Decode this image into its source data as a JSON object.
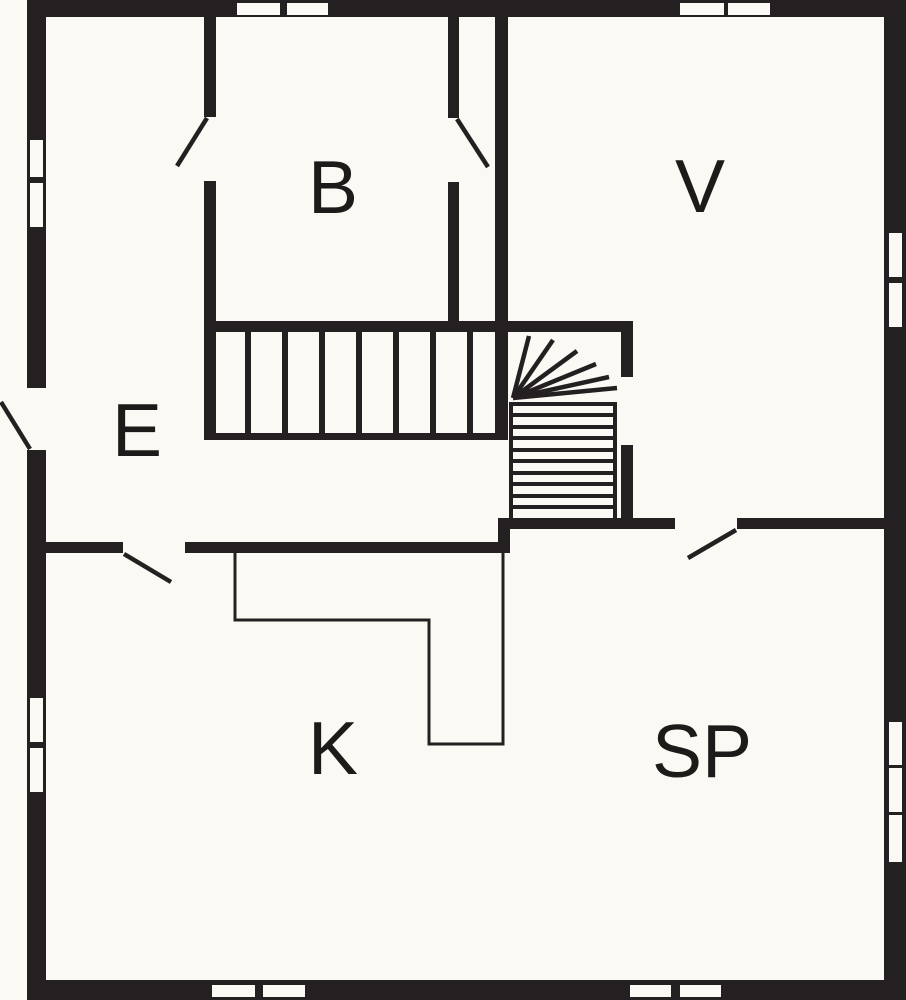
{
  "floorplan": {
    "meta": {
      "width": 906,
      "height": 1000,
      "type": "floor-plan"
    },
    "colors": {
      "wall": "#241f20",
      "floor": "#faf9f3",
      "line": "#241f20",
      "label": "#1d1b1a"
    },
    "rooms": [
      {
        "id": "b",
        "label": "B",
        "cx": 333,
        "cy": 187,
        "font": 75
      },
      {
        "id": "v",
        "label": "V",
        "cx": 700,
        "cy": 186,
        "font": 75
      },
      {
        "id": "e",
        "label": "E",
        "cx": 137,
        "cy": 430,
        "font": 75
      },
      {
        "id": "k",
        "label": "K",
        "cx": 333,
        "cy": 748,
        "font": 75
      },
      {
        "id": "sp",
        "label": "SP",
        "cx": 702,
        "cy": 751,
        "font": 75
      }
    ],
    "walls": [
      {
        "name": "exterior-wall-left",
        "x": 27,
        "y": 0,
        "w": 19,
        "h": 1000
      },
      {
        "name": "exterior-wall-top",
        "x": 27,
        "y": 0,
        "w": 879,
        "h": 17
      },
      {
        "name": "exterior-wall-right",
        "x": 884,
        "y": 0,
        "w": 22,
        "h": 1000
      },
      {
        "name": "exterior-wall-bottom",
        "x": 27,
        "y": 980,
        "w": 879,
        "h": 20
      },
      {
        "name": "wall-b-left-upper",
        "x": 204,
        "y": 17,
        "w": 12,
        "h": 100
      },
      {
        "name": "wall-b-left-lower",
        "x": 204,
        "y": 181,
        "w": 12,
        "h": 259
      },
      {
        "name": "wall-b-right-upper",
        "x": 448,
        "y": 17,
        "w": 11,
        "h": 101
      },
      {
        "name": "wall-b-right-lower",
        "x": 448,
        "y": 182,
        "w": 11,
        "h": 150
      },
      {
        "name": "wall-v-left",
        "x": 495,
        "y": 17,
        "w": 13,
        "h": 420
      },
      {
        "name": "wall-stair-top",
        "x": 204,
        "y": 321,
        "w": 429,
        "h": 11
      },
      {
        "name": "wall-stair-right-upper",
        "x": 621,
        "y": 332,
        "w": 12,
        "h": 45
      },
      {
        "name": "wall-stair-right-lower",
        "x": 621,
        "y": 445,
        "w": 12,
        "h": 74
      },
      {
        "name": "wall-stair-bottom-west",
        "x": 498,
        "y": 518,
        "w": 177,
        "h": 11
      },
      {
        "name": "wall-stair-bottom-east",
        "x": 737,
        "y": 518,
        "w": 149,
        "h": 11
      },
      {
        "name": "wall-stair-connector",
        "x": 498,
        "y": 518,
        "w": 12,
        "h": 35
      },
      {
        "name": "wall-e-k-west",
        "x": 46,
        "y": 542,
        "w": 77,
        "h": 11
      },
      {
        "name": "wall-e-k-east",
        "x": 185,
        "y": 542,
        "w": 323,
        "h": 11
      }
    ],
    "windows": [
      {
        "name": "window-left-1",
        "x": 30,
        "y": 140,
        "w": 13,
        "h": 37
      },
      {
        "name": "window-left-2",
        "x": 30,
        "y": 183,
        "w": 13,
        "h": 44
      },
      {
        "name": "window-left-3",
        "x": 30,
        "y": 698,
        "w": 13,
        "h": 44
      },
      {
        "name": "window-left-4",
        "x": 30,
        "y": 748,
        "w": 13,
        "h": 44
      },
      {
        "name": "window-top-1",
        "x": 237,
        "y": 3,
        "w": 43,
        "h": 12
      },
      {
        "name": "window-top-2",
        "x": 287,
        "y": 3,
        "w": 41,
        "h": 12
      },
      {
        "name": "window-top-3",
        "x": 680,
        "y": 3,
        "w": 44,
        "h": 12
      },
      {
        "name": "window-top-4",
        "x": 728,
        "y": 3,
        "w": 42,
        "h": 12
      },
      {
        "name": "window-bottom-1",
        "x": 212,
        "y": 985,
        "w": 43,
        "h": 12
      },
      {
        "name": "window-bottom-2",
        "x": 263,
        "y": 985,
        "w": 42,
        "h": 12
      },
      {
        "name": "window-bottom-3",
        "x": 630,
        "y": 985,
        "w": 41,
        "h": 12
      },
      {
        "name": "window-bottom-4",
        "x": 680,
        "y": 985,
        "w": 41,
        "h": 12
      },
      {
        "name": "window-right-1",
        "x": 889,
        "y": 233,
        "w": 13,
        "h": 44
      },
      {
        "name": "window-right-2",
        "x": 889,
        "y": 283,
        "w": 13,
        "h": 44
      },
      {
        "name": "window-right-3",
        "x": 889,
        "y": 722,
        "w": 13,
        "h": 43
      },
      {
        "name": "window-right-4",
        "x": 889,
        "y": 768,
        "w": 13,
        "h": 44
      },
      {
        "name": "window-right-5",
        "x": 889,
        "y": 815,
        "w": 13,
        "h": 47
      }
    ],
    "door_gaps": [
      {
        "name": "entry-door-gap",
        "x": 27,
        "y": 388,
        "w": 19,
        "h": 62
      }
    ],
    "door_leaves": [
      {
        "name": "entry-door-leaf",
        "x1": 1,
        "y1": 402,
        "x2": 30,
        "y2": 449,
        "stroke": 4.5
      },
      {
        "name": "door-leaf-e-b",
        "x1": 207,
        "y1": 118,
        "x2": 177,
        "y2": 166,
        "stroke": 4.5
      },
      {
        "name": "door-leaf-b-landing",
        "x1": 457,
        "y1": 119,
        "x2": 488,
        "y2": 167,
        "stroke": 4.5
      },
      {
        "name": "door-leaf-e-k",
        "x1": 124,
        "y1": 554,
        "x2": 171,
        "y2": 582,
        "stroke": 4.5
      },
      {
        "name": "door-leaf-sp",
        "x1": 736,
        "y1": 530,
        "x2": 688,
        "y2": 558,
        "stroke": 4.5
      }
    ],
    "stairs": {
      "upper_flight": {
        "tread_xs": [
          248,
          285,
          322,
          359,
          396,
          433,
          470
        ],
        "top": 332,
        "bottom": 434,
        "stroke": 6,
        "base_rail": {
          "x1": 204,
          "y1": 436.5,
          "x2": 508,
          "y2": 436.5,
          "stroke": 7
        }
      },
      "winder_fan": {
        "cx": 513,
        "cy": 398,
        "stroke": 4.5,
        "tips": [
          [
            529,
            336
          ],
          [
            553,
            340
          ],
          [
            577,
            351
          ],
          [
            596,
            364
          ],
          [
            609,
            377
          ],
          [
            617,
            388
          ]
        ]
      },
      "lower_flight": {
        "tread_ys": [
          404,
          415,
          427,
          438,
          450,
          461,
          473,
          484,
          496,
          507
        ],
        "left": 509,
        "right": 617,
        "stroke": 4,
        "rails": [
          {
            "x1": 511,
            "y1": 403,
            "x2": 511,
            "y2": 518
          },
          {
            "x1": 615,
            "y1": 403,
            "x2": 615,
            "y2": 518
          }
        ]
      }
    },
    "kitchen_counter": {
      "name": "kitchen-counter-outline",
      "points": [
        [
          235,
          553
        ],
        [
          235,
          620
        ],
        [
          429,
          620
        ],
        [
          429,
          744
        ],
        [
          503,
          744
        ],
        [
          503,
          553
        ]
      ],
      "stroke": 3
    }
  }
}
